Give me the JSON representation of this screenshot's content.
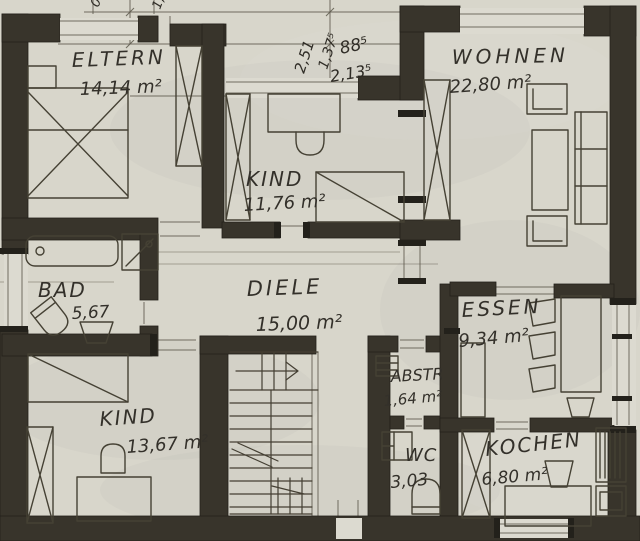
{
  "colors": {
    "paper": "#d8d6cb",
    "wall": "#38342b",
    "pencil": "#5d584c",
    "label": "#33302a"
  },
  "rooms": {
    "eltern": {
      "name": "ELTERN",
      "area": "14,14 m²"
    },
    "kind_top": {
      "name": "KIND",
      "area": "11,76 m²"
    },
    "wohnen": {
      "name": "WOHNEN",
      "area": "22,80 m²"
    },
    "bad": {
      "name": "BAD",
      "area": "5,67"
    },
    "diele": {
      "name": "DIELE",
      "area": "15,00 m²"
    },
    "essen": {
      "name": "ESSEN",
      "area": "9,34 m²"
    },
    "kind_bottom": {
      "name": "KIND",
      "area": "13,67 m²"
    },
    "abstr": {
      "name": "ABSTR",
      "area": "1,64 m²"
    },
    "wc": {
      "name": "WC",
      "area": "3,03"
    },
    "kochen": {
      "name": "KOCHEN",
      "area": "6,80 m²"
    }
  },
  "dims": {
    "vertical_a": "2,51",
    "vertical_b": "1,37⁵",
    "width_a": "88⁵",
    "width_b": "2,13⁵",
    "edge_fragment_a": "0",
    "edge_fragment_b": "1,"
  }
}
